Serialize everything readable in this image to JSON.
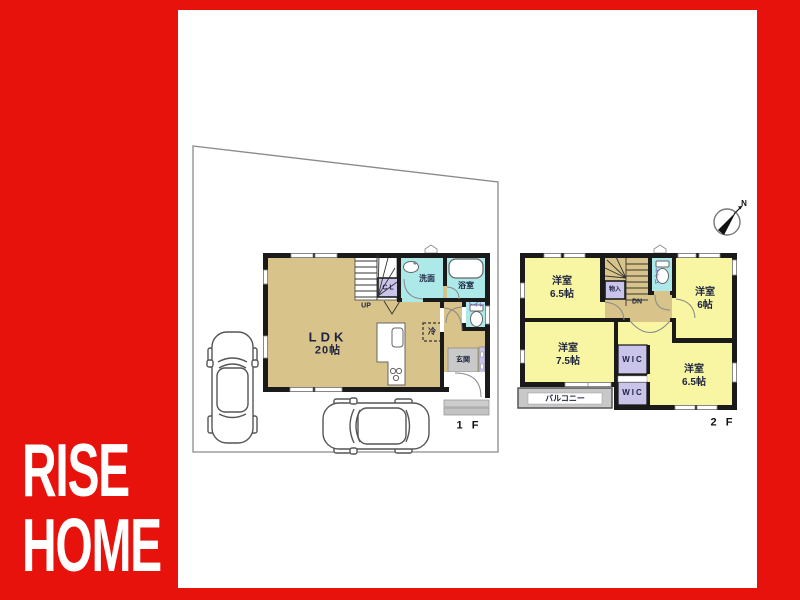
{
  "brand": {
    "line1": "RISE",
    "line2": "HOME"
  },
  "compass": {
    "north": "N"
  },
  "floor1": {
    "label": "1 F",
    "ldk": {
      "name": "LDK",
      "size": "20帖"
    },
    "stairs": "UP",
    "closet": "CL",
    "washroom": "洗面",
    "bath": "浴室",
    "toilet": "トイレ",
    "fridge": "冷",
    "entrance": "玄関"
  },
  "floor2": {
    "label": "2 F",
    "stairs": "DN",
    "toilet": "トイレ",
    "storage": "物入",
    "room_nw": {
      "name": "洋室",
      "size": "6.5帖"
    },
    "room_ne": {
      "name": "洋室",
      "size": "6帖"
    },
    "room_sw": {
      "name": "洋室",
      "size": "7.5帖"
    },
    "room_se": {
      "name": "洋室",
      "size": "6.5帖"
    },
    "wic_upper": "WIC",
    "wic_lower": "WIC",
    "balcony": "バルコニー"
  },
  "colors": {
    "frame_red": "#e8120d",
    "room_yellow": "#f8f6a2",
    "room_tan": "#d8c48a",
    "wet_cyan": "#aee9ea",
    "closet_purple": "#cbc4ea",
    "porch_gray": "#c8c8c8",
    "wall_black": "#1a1a1a"
  }
}
